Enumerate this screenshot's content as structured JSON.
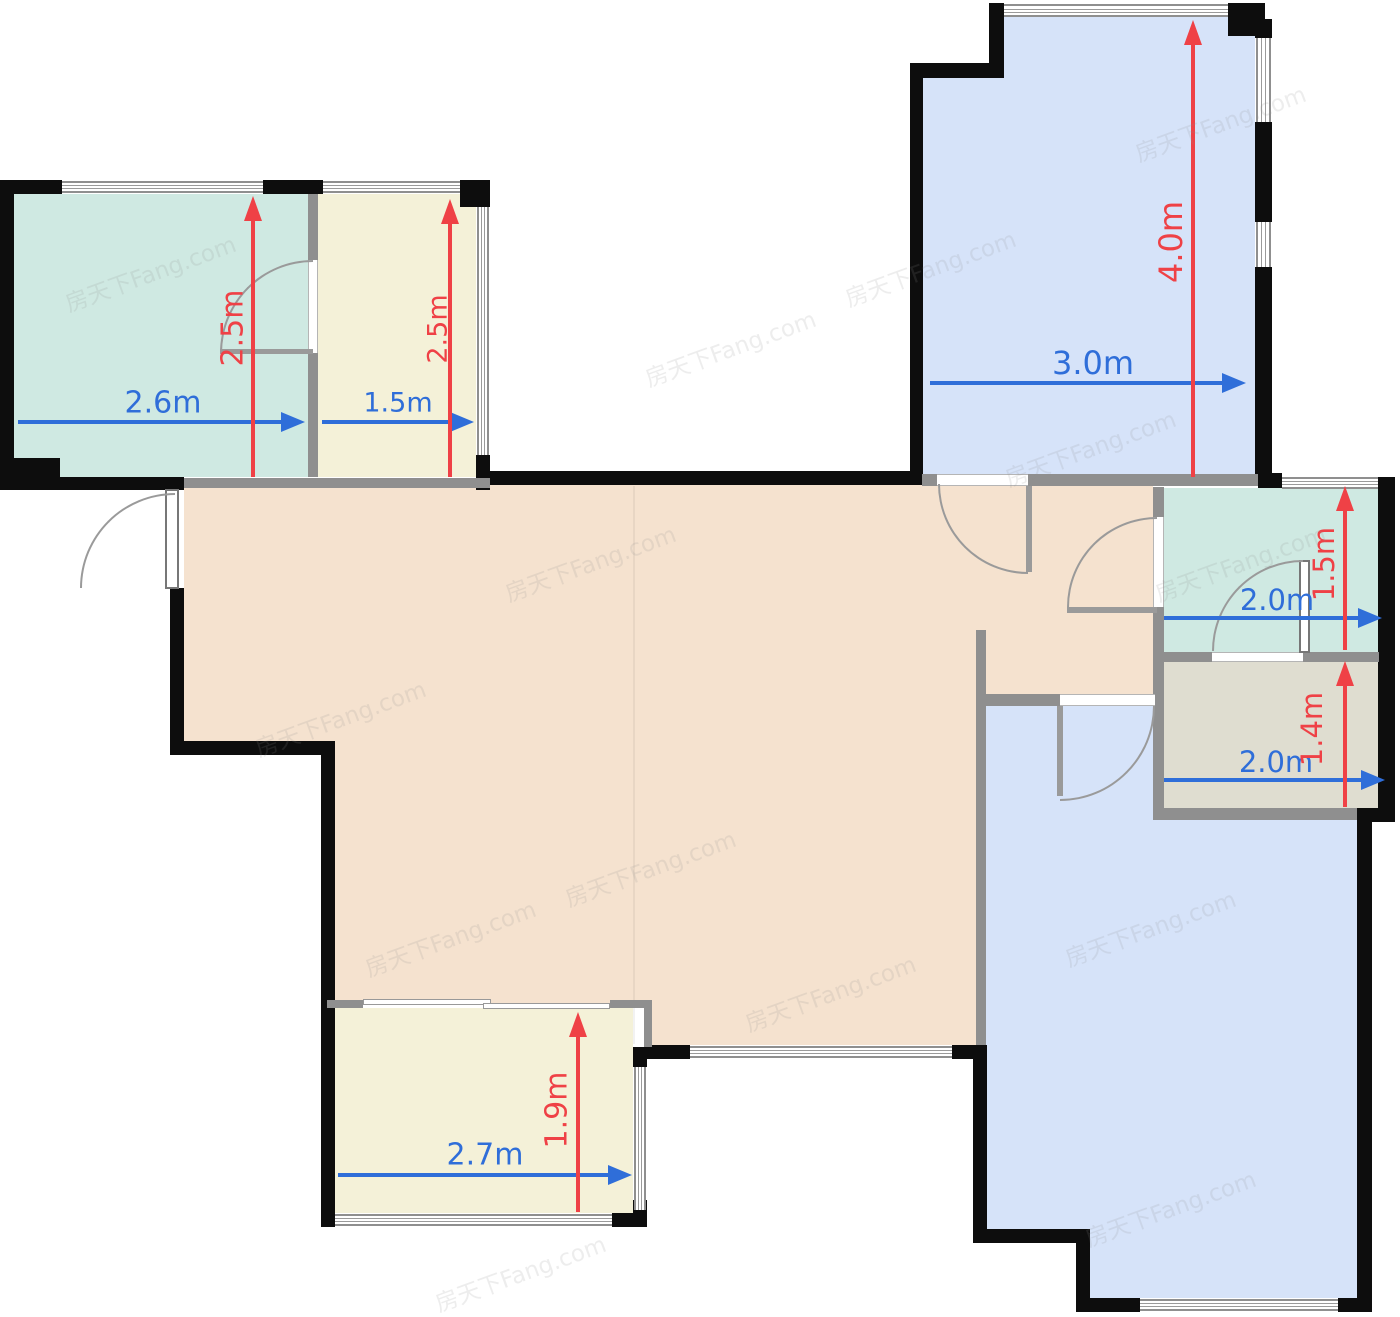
{
  "plan": {
    "type": "floor-plan",
    "watermark": "房天下Fang.com",
    "colors": {
      "exterior_wall": "#0d0d0d",
      "interior_wall": "#8f8f8f",
      "dim_width_blue": "#2f6ed9",
      "dim_height_red": "#ef4146",
      "room_teal": "#cfe9e2",
      "room_cream": "#f4f1d8",
      "room_blue": "#d6e3f9",
      "room_peach": "#f5e2cf",
      "room_olive": "#dfddd0"
    },
    "rooms": [
      {
        "id": "room-top-left-teal",
        "width_label": "2.6m",
        "height_label": "2.5m"
      },
      {
        "id": "room-top-left-cream",
        "width_label": "1.5m",
        "height_label": "2.5m"
      },
      {
        "id": "room-top-right-blue",
        "width_label": "3.0m",
        "height_label": "4.0m"
      },
      {
        "id": "room-mid-right-teal",
        "width_label": "2.0m",
        "height_label": "1.5m"
      },
      {
        "id": "room-mid-right-olive",
        "width_label": "2.0m",
        "height_label": "1.4m"
      },
      {
        "id": "room-bottom-left-cream",
        "width_label": "2.7m",
        "height_label": "1.9m"
      }
    ]
  }
}
